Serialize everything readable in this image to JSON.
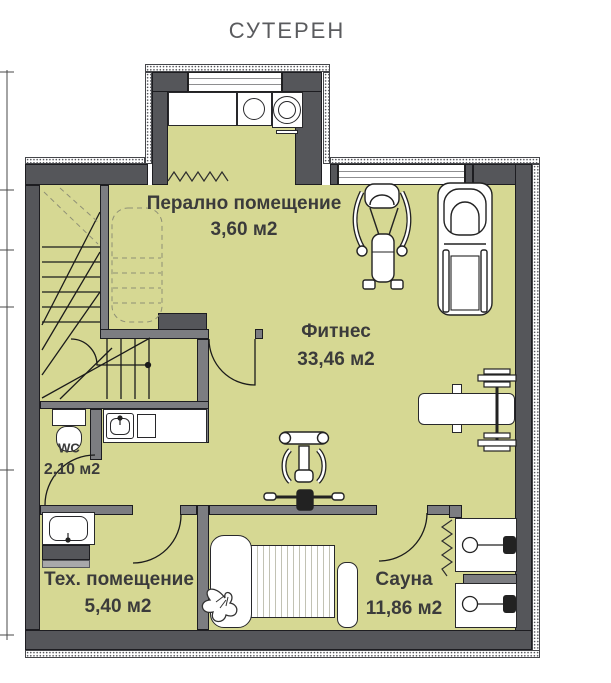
{
  "title": "СУТЕРЕН",
  "rooms": {
    "laundry": {
      "name": "Перално помещение",
      "area": "3,60 м2"
    },
    "fitness": {
      "name": "Фитнес",
      "area": "33,46 м2"
    },
    "wc": {
      "name": "WC",
      "area": "2,10 м2"
    },
    "tech": {
      "name": "Тех. помещение",
      "area": "5,40 м2"
    },
    "sauna": {
      "name": "Сауна",
      "area": "11,86 м2"
    }
  },
  "fixtures": [
    "staircase",
    "washing-machine",
    "dryer",
    "laundry-counter",
    "radiator-zigzag",
    "elliptical-trainer",
    "treadmill",
    "weight-bench",
    "barbell",
    "exercise-bike",
    "toilet",
    "washbasin-counter",
    "technical-sink",
    "shelf",
    "massage-lounger",
    "plant",
    "sauna-bench-mat",
    "sauna-bench",
    "sauna-heater-zigzag",
    "shower-cabin",
    "shower-cabin",
    "window",
    "window",
    "door-swing"
  ],
  "colors": {
    "floor": "#d6d893",
    "wall": "#55565a",
    "pwall": "#7c7d81",
    "line": "#1d1d21",
    "label": "#3b3b3b",
    "title": "#5a5b5e"
  }
}
